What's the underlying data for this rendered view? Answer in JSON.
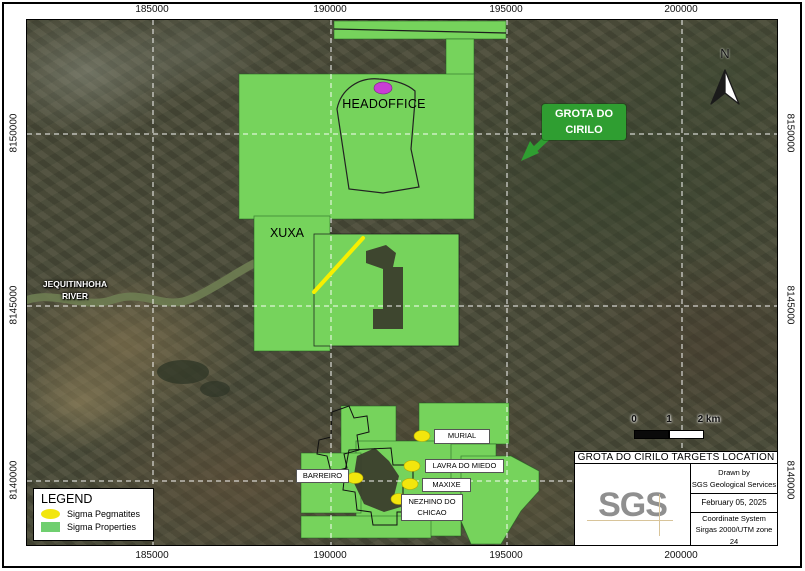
{
  "figure": {
    "axis": {
      "top": [
        "185000",
        "190000",
        "195000",
        "200000"
      ],
      "bottom": [
        "185000",
        "190000",
        "195000",
        "200000"
      ],
      "left": [
        "8150000",
        "8145000",
        "8140000"
      ],
      "right": [
        "8150000",
        "8145000",
        "8140000"
      ]
    },
    "north_label": "N",
    "map_labels": {
      "headoffice": "HEADOFFICE",
      "xuxa": "XUXA",
      "river_line1": "JEQUITINHOHA",
      "river_line2": "RIVER"
    },
    "callout": {
      "line1": "GROTA DO",
      "line2": "CIRILO"
    },
    "targets": [
      {
        "name": "MURIAL"
      },
      {
        "name": "LAVRA DO MIEDO"
      },
      {
        "name": "BARREIRO"
      },
      {
        "name": "MAXIXE"
      },
      {
        "name": "NEZHINO DO CHICAO"
      }
    ],
    "scalebar": {
      "tick0": "0",
      "tick1": "1",
      "tick2": "2 km"
    },
    "legend": {
      "title": "LEGEND",
      "items": [
        {
          "label": "Sigma Pegmatites"
        },
        {
          "label": "Sigma Properties"
        }
      ]
    },
    "title_block": {
      "title": "GROTA DO CIRILO TARGETS LOCATION",
      "logo": "SGS",
      "drawn_by_line1": "Drawn by",
      "drawn_by_line2": "SGS Geological Services",
      "date": "February 05, 2025",
      "coord_line1": "Coordinate System",
      "coord_line2": "Sirgas 2000/UTM zone 24"
    },
    "colors": {
      "property_green": "#76d35c",
      "pegmatite_yellow": "#f2e60d",
      "callout_green": "#2f9e31",
      "headoffice_magenta": "#c93ed4",
      "gridline_white": "#ffffff"
    }
  }
}
